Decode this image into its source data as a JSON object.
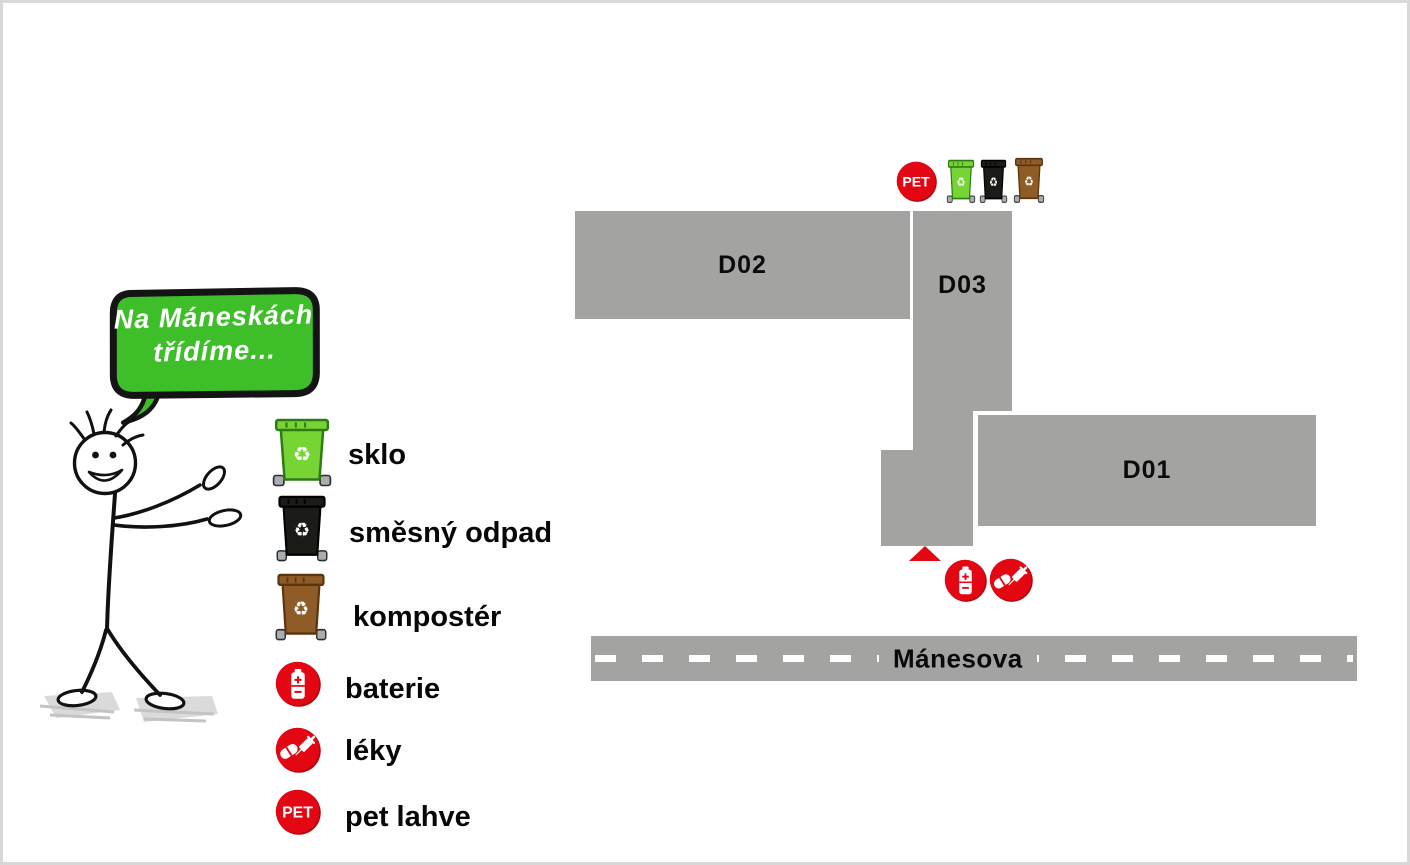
{
  "colors": {
    "building_gray": "#a3a3a2",
    "street_gray": "#a3a3a2",
    "accent_red": "#e30613",
    "accent_red_dark": "#b50510",
    "bubble_green": "#3ebf2a",
    "glass_bin_green": "#76d434",
    "mixed_bin_black": "#1b1b18",
    "compost_bin_brown": "#8f5b26"
  },
  "speech_bubble": {
    "line1": "Na Máneskách",
    "line2": "třídíme..."
  },
  "badges": {
    "pet_text": "PET",
    "recycle_glyph": "♻"
  },
  "legend": {
    "items": [
      {
        "icon": "glass-bin-icon",
        "label": "sklo"
      },
      {
        "icon": "mixed-waste-bin-icon",
        "label": "směsný odpad"
      },
      {
        "icon": "composter-bin-icon",
        "label": "kompostér"
      },
      {
        "icon": "battery-badge-icon",
        "label": "baterie"
      },
      {
        "icon": "medicine-badge-icon",
        "label": "léky"
      },
      {
        "icon": "pet-badge-icon",
        "label": "pet lahve"
      }
    ]
  },
  "map": {
    "buildings": [
      {
        "label": "D02"
      },
      {
        "label": "D03"
      },
      {
        "label": "D01"
      }
    ],
    "street": {
      "label": "Mánesova"
    },
    "station_top": {
      "badges": [
        "pet"
      ],
      "bins": [
        "glass",
        "mixed",
        "compost"
      ]
    },
    "station_bottom": {
      "badges": [
        "battery",
        "medicine"
      ]
    }
  }
}
